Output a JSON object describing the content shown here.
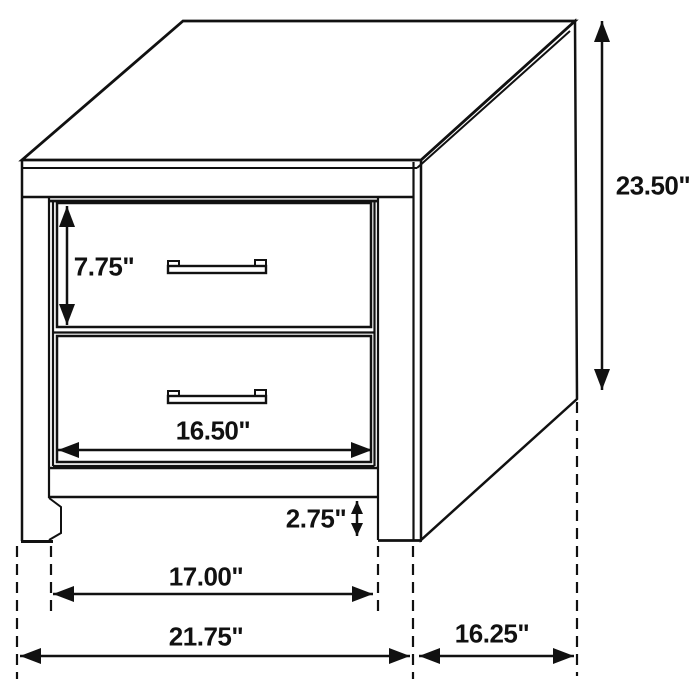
{
  "diagram": {
    "product": "2-drawer nightstand dimension drawing",
    "unit": "inches",
    "line_color": "#111111",
    "background_color": "#ffffff",
    "drawer_count": 2,
    "dimensions": {
      "overall_height": "23.50\"",
      "drawer_front_height": "7.75\"",
      "drawer_front_width": "16.50\"",
      "base_clearance": "2.75\"",
      "inner_leg_span": "17.00\"",
      "overall_width": "21.75\"",
      "overall_depth": "16.25\""
    }
  }
}
